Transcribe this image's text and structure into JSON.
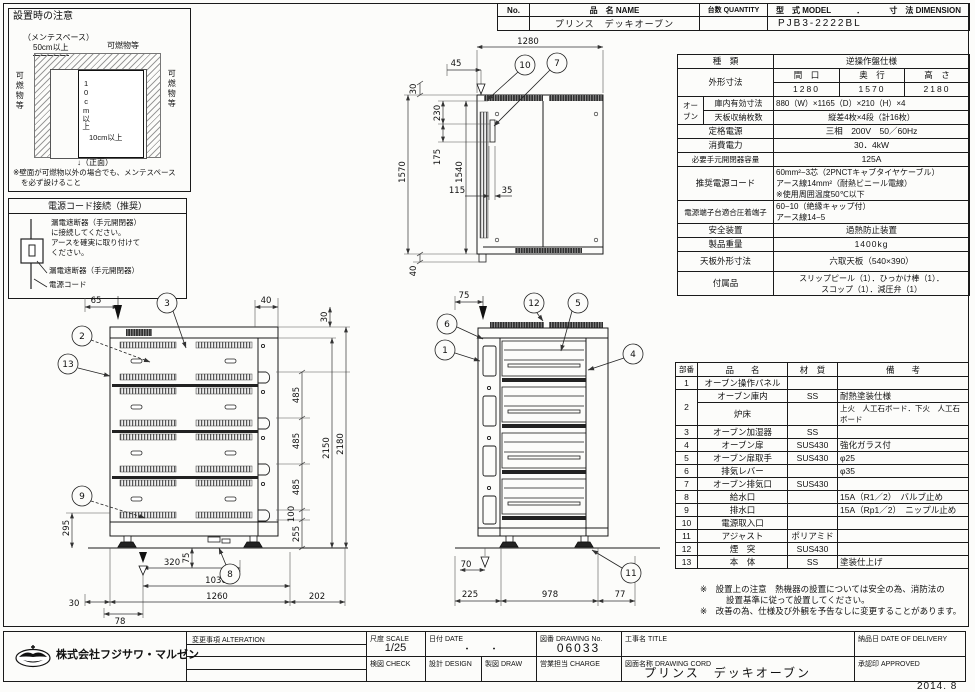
{
  "sheet": {
    "issue_date": "2014. 8"
  },
  "header_table": {
    "no_label": "No.",
    "name_label": "品　名 NAME",
    "qty_label": "台数 QUANTITY",
    "model_label": "型　式 MODEL",
    "dot": "．",
    "dim_label": "寸　法 DIMENSION",
    "name_value": "プリンス　デッキオーブン",
    "qty_value": "",
    "model_value": "PJB3-2222BL"
  },
  "install_note": {
    "title": "設置時の注意",
    "mente_label": "（メンテスペース）",
    "mente_value": "50cm以上",
    "combustible_top": "可燃物等",
    "combustible_left": "可燃物等",
    "combustible_right": "可燃物等",
    "clear_v": "10cm以上",
    "clear_h": "10cm以上",
    "front_label": "↓（正面）",
    "footnote1": "※壁面が可燃物以外の場合でも、メンテスペース",
    "footnote2": "を必ず設けること"
  },
  "power_note": {
    "title": "電源コード接続（推奨）",
    "line1": "漏電遮断器（手元開閉器）",
    "line2": "に接続してください。",
    "line3": "アースを確実に取り付けて",
    "line4": "ください。",
    "breaker_label": "漏電遮断器（手元開閉器）",
    "cord_label": "電源コード"
  },
  "spec_table": {
    "kind_label": "種　類",
    "kind_value": "逆操作盤仕様",
    "outer_label": "外形寸法",
    "w_label": "間　口",
    "d_label": "奥　行",
    "h_label": "高　さ",
    "w_value": "1280",
    "d_value": "1570",
    "h_value": "2180",
    "oven_label": "オーブン",
    "inner_label": "庫内有効寸法",
    "inner_value": "880（W）×1165（D）×210（H）×4",
    "tray_label": "天板収納枚数",
    "tray_value": "縦差4枚×4段（計16枚）",
    "power_label": "定格電源",
    "power_value": "三相　200V　50／60Hz",
    "consumption_label": "消費電力",
    "consumption_value": "30．4kW",
    "breaker_label": "必要手元開閉器容量",
    "breaker_value": "125A",
    "cord_label": "推奨電源コード",
    "cord_value1": "60mm²−3芯（2PNCTキャブタイヤケーブル）",
    "cord_value2": "アース線14mm²（耐熱ビニール電線）",
    "cord_value3": "※使用周囲温度50℃以下",
    "terminal_label": "電源端子台適合圧着端子",
    "terminal_value1": "60−10（絶縁キャップ付）",
    "terminal_value2": "アース線14−5",
    "safety_label": "安全装置",
    "safety_value": "過熱防止装置",
    "weight_label": "製品重量",
    "weight_value": "1400kg",
    "pan_label": "天板外形寸法",
    "pan_value": "六取天板（540×390）",
    "accessory_label": "付属品",
    "accessory_value1": "スリップピール（1）．ひっかけ棒（1）．",
    "accessory_value2": "スコップ（1）．減圧弁（1）"
  },
  "parts_table": {
    "headers": {
      "no": "部番",
      "name": "品　　名",
      "material": "材　質",
      "note": "備　　考"
    },
    "rows": [
      {
        "no": "1",
        "name": "オーブン操作パネル",
        "material": "",
        "note": ""
      },
      {
        "no": "2",
        "name": "オーブン庫内",
        "material": "SS",
        "note": "耐熱塗装仕様"
      },
      {
        "no": "",
        "name": "炉床",
        "material": "",
        "note": "上火　人工石ボード．下火　人工石ボード"
      },
      {
        "no": "3",
        "name": "オーブン加湿器",
        "material": "SS",
        "note": ""
      },
      {
        "no": "4",
        "name": "オーブン扉",
        "material": "SUS430",
        "note": "強化ガラス付"
      },
      {
        "no": "5",
        "name": "オーブン扉取手",
        "material": "SUS430",
        "note": "φ25"
      },
      {
        "no": "6",
        "name": "排気レバー",
        "material": "",
        "note": "φ35"
      },
      {
        "no": "7",
        "name": "オーブン排気口",
        "material": "SUS430",
        "note": ""
      },
      {
        "no": "8",
        "name": "給水口",
        "material": "",
        "note": "15A（R1／2）　バルブ止め"
      },
      {
        "no": "9",
        "name": "排水口",
        "material": "",
        "note": "15A（Rp1／2）　ニップル止め"
      },
      {
        "no": "10",
        "name": "電源取入口",
        "material": "",
        "note": ""
      },
      {
        "no": "11",
        "name": "アジャスト",
        "material": "ポリアミド",
        "note": ""
      },
      {
        "no": "12",
        "name": "煙　突",
        "material": "SUS430",
        "note": ""
      },
      {
        "no": "13",
        "name": "本　体",
        "material": "SS",
        "note": "塗装仕上げ"
      }
    ]
  },
  "notes": {
    "line1": "※　設置上の注意　熱機器の設置については安全の為、消防法の",
    "line2": "設置基準に従って設置してください。",
    "line3": "※　改善の為、仕様及び外観を予告なしに変更することがあります。"
  },
  "title_block": {
    "company": "株式会社フジサワ・マルゼン",
    "alteration_label": "変更事項 ALTERATION",
    "scale_label": "尺度 SCALE",
    "scale_value": "1/25",
    "date_label": "日付 DATE",
    "date_value": "・　　・",
    "drawing_no_label": "図番 DRAWING No.",
    "drawing_no_value": "06033",
    "check_label": "検図 CHECK",
    "design_label": "設計 DESIGN",
    "draw_label": "製図 DRAW",
    "charge_label": "営業担当 CHARGE",
    "title_label": "工事名 TITLE",
    "drawing_name_label": "図面名称 DRAWING CORD",
    "drawing_name_value": "プリンス　デッキオーブン",
    "delivery_label": "納品日 DATE OF DELIVERY",
    "approved_label": "承認印 APPROVED"
  },
  "callouts": {
    "n1": "1",
    "n2": "2",
    "n3": "3",
    "n4": "4",
    "n5": "5",
    "n6": "6",
    "n7": "7",
    "n8": "8",
    "n9": "9",
    "n10": "10",
    "n11": "11",
    "n12": "12",
    "n13": "13"
  },
  "dims": {
    "side": {
      "d65": "65",
      "d40": "40",
      "d30": "30",
      "d485": "485",
      "d100": "100",
      "d255": "255",
      "d2150": "2150",
      "d2180": "2180",
      "d295": "295",
      "d75": "75",
      "d320": "320",
      "d1030": "1030",
      "d30b": "30",
      "d1260": "1260",
      "d202": "202",
      "d78": "78"
    },
    "top": {
      "d1280": "1280",
      "d45": "45",
      "d30": "30",
      "d230": "230",
      "d175": "175",
      "d1570": "1570",
      "d1540": "1540",
      "d115": "115",
      "d35": "35",
      "d40": "40"
    },
    "front": {
      "d75": "75",
      "d70": "70",
      "d225": "225",
      "d978": "978",
      "d77": "77"
    }
  }
}
